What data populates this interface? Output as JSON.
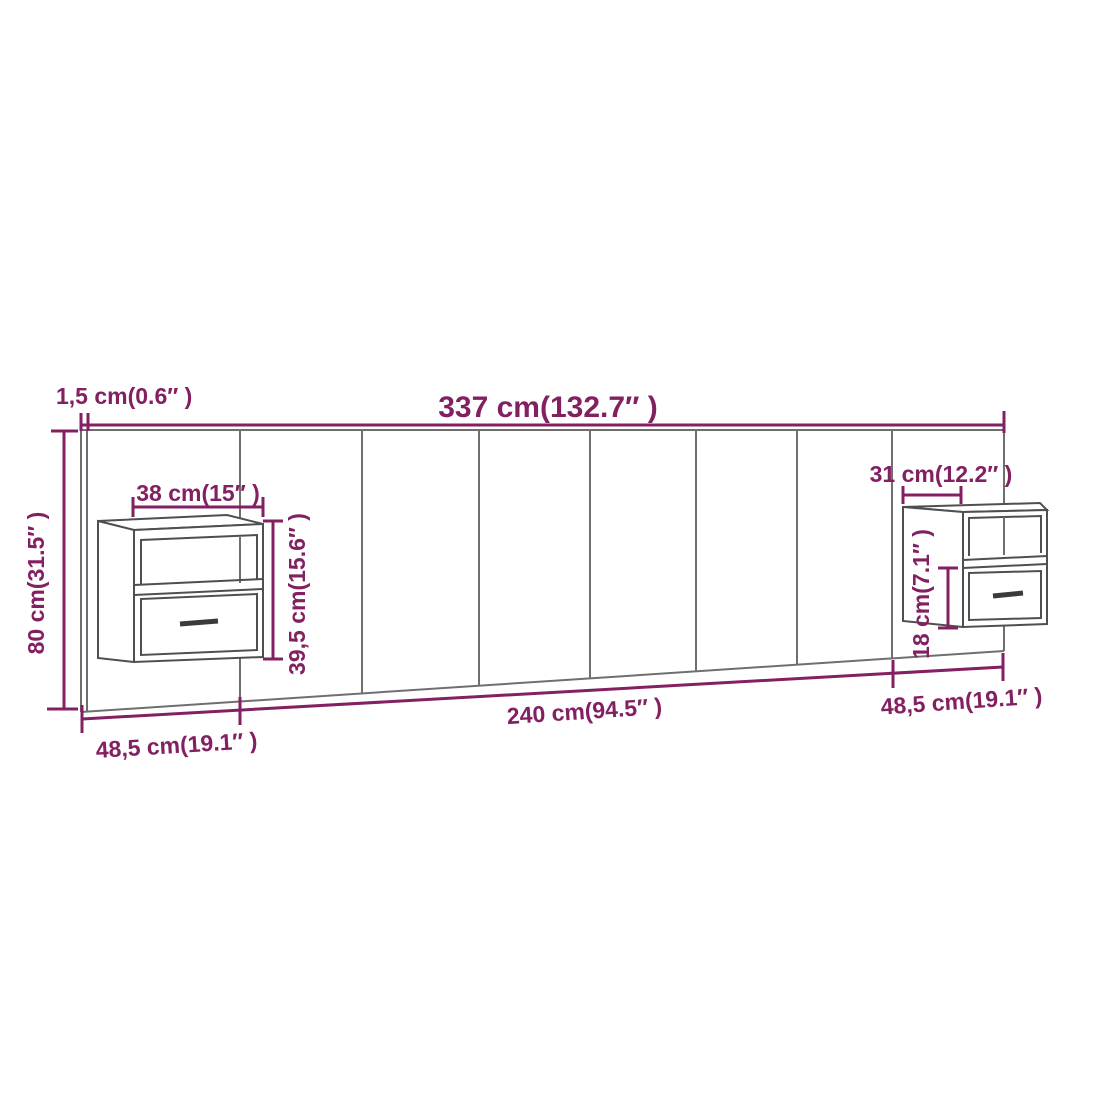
{
  "diagram_title": "headboard-with-floating-bedside-cabinets-dimension-diagram",
  "colors": {
    "dimension_accent": "#832062",
    "headboard_outline": "#6f6f6f",
    "cabinet_outline": "#4f4f4f",
    "background": "#ffffff"
  },
  "labels": {
    "overall_width": "337 cm(132.7″ )",
    "panel_thickness": "1,5 cm(0.6″ )",
    "overall_height": "80 cm(31.5″ )",
    "left_cabinet_width": "38 cm(15″ )",
    "left_cabinet_height": "39,5 cm(15.6″ )",
    "right_cabinet_depth": "31 cm(12.2″ )",
    "right_cabinet_drawer_height": "18 cm(7.1″ )",
    "bottom_left_segment": "48,5 cm(19.1″ )",
    "bottom_middle_segment": "240 cm(94.5″ )",
    "bottom_right_segment": "48,5 cm(19.1″ )"
  }
}
